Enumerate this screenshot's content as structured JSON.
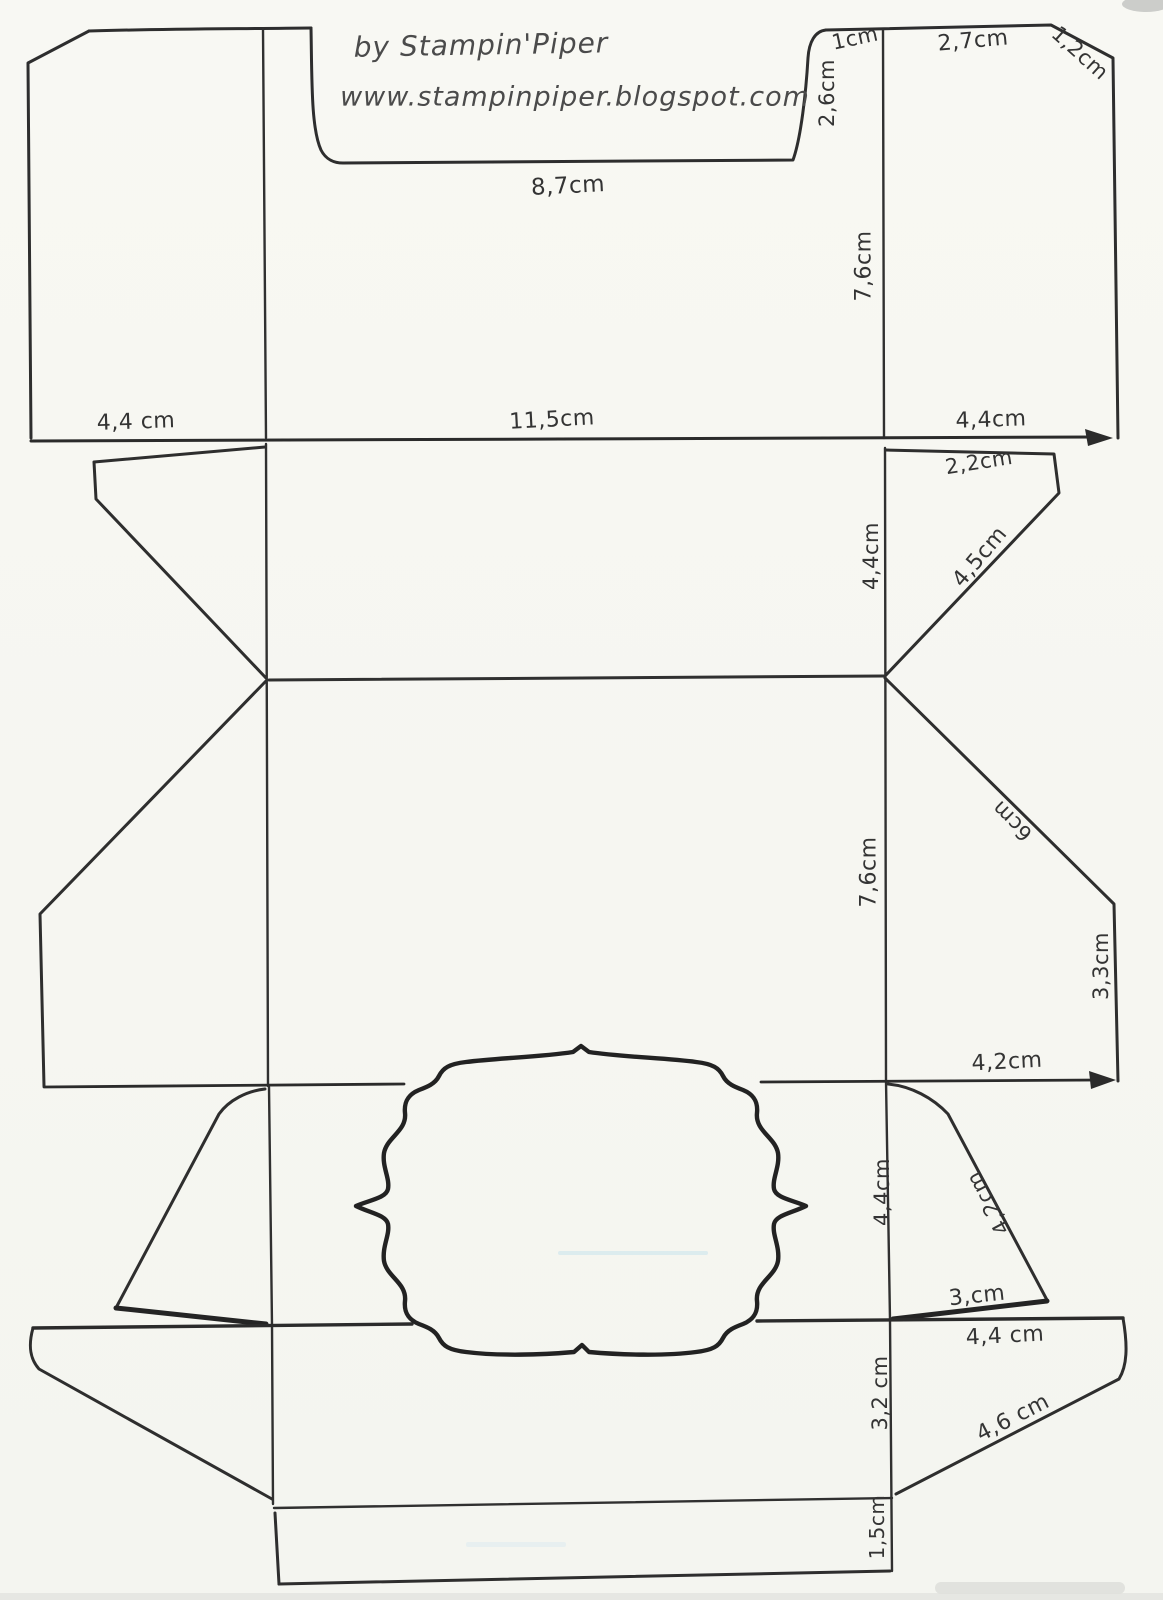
{
  "header": {
    "credit": "by Stampin'Piper",
    "url": "www.stampinpiper.blogspot.com"
  },
  "colors": {
    "ink": "#2e2e2e",
    "paper": "#f7f7f2"
  },
  "dims": [
    {
      "text": "1cm"
    },
    {
      "text": "2,7cm"
    },
    {
      "text": "1,2cm"
    },
    {
      "text": "2,6cm"
    },
    {
      "text": "8,7cm"
    },
    {
      "text": "7,6cm"
    },
    {
      "text": "4,4 cm"
    },
    {
      "text": "11,5cm"
    },
    {
      "text": "4,4cm"
    },
    {
      "text": "2,2cm"
    },
    {
      "text": "4,4cm"
    },
    {
      "text": "4,5cm"
    },
    {
      "text": "7,6cm"
    },
    {
      "text": "6cm"
    },
    {
      "text": "3,3cm"
    },
    {
      "text": "4,2cm"
    },
    {
      "text": "4,4cm"
    },
    {
      "text": "4,2cm"
    },
    {
      "text": "3,cm"
    },
    {
      "text": "4,4 cm"
    },
    {
      "text": "3,2 cm"
    },
    {
      "text": "4,6 cm"
    },
    {
      "text": "1,5cm"
    }
  ]
}
